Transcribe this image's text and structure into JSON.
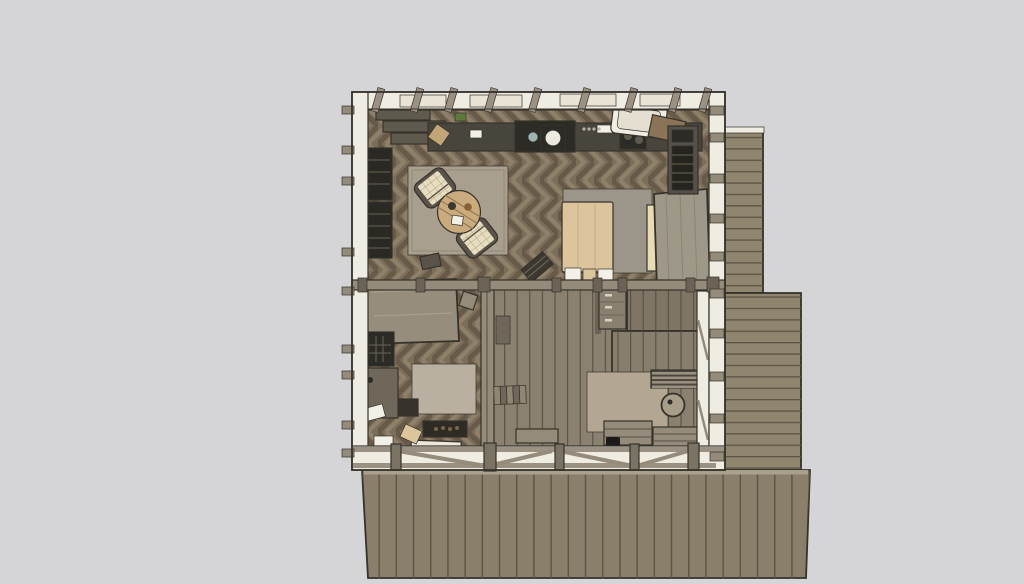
{
  "scene": {
    "kind": "3d-model-top-view",
    "subject": "Top-down rendering of a timber cabin interior with wrap-around wooden deck",
    "style": "sketch-rendered, muted earth tones, no visible text or UI chrome"
  },
  "colors": {
    "background": "#d5d4d6",
    "outline": "#35322b",
    "wall_fill": "#efece1",
    "skylight": "#e8e3d4",
    "beam": "#948b7b",
    "beam_dark": "#6b6355",
    "post": "#7a7263",
    "deck_board": "#90856f",
    "deck_board_dark": "#8a7f6a",
    "deck_line": "#5d5546",
    "deck_edge": "#a89f8c",
    "floor_base": "#7d6e5a",
    "floor_chevron_dark": "#685a48",
    "floor_chevron_light": "#8f806a",
    "hall_plank": "#8a8170",
    "hall_plank_dark": "#7e7565",
    "hall_plank_mid": "#877e6d",
    "hall_plank_line": "#564f43",
    "rug_living": "#a99f8e",
    "rug_living_border": "#948a79",
    "rug_study": "#b9b0a1",
    "rug_porch": "#b3a692",
    "armchair_fabric": "#e7ddc1",
    "armchair_grid": "#b3a17b",
    "armchair_frame": "#5a5349",
    "coffee_table_wood": "#c9ab7e",
    "coffee_table_ring": "#8a6f4e",
    "bowl_dark": "#3b382f",
    "bowl_brown": "#8a5f33",
    "bed_blanket": "#dcc59d",
    "bed_blanket_line": "#c5ad85",
    "bed_carpet": "#9c968a",
    "mattress_roll": "#e9dbb4",
    "pillow": "#f3f0e7",
    "wardrobe": "#9e9889",
    "wardrobe_grain": "#8a8477",
    "counter_base": "#48453c",
    "counter_dark": "#2c2b26",
    "counter_gray": "#5f5a4e",
    "sink": "#eceadf",
    "sink_small": "#9fb3b5",
    "cutting_board": "#c3a678",
    "accent_green": "#5d7a3a",
    "knob": "#b9b2a2",
    "bathtub": "#f0ede3",
    "bathtub_panel": "#e4dfd0",
    "cabinet_wood": "#8a7356",
    "shower_frame": "#55514a",
    "shower_dark": "#26241f",
    "shelf_dark": "#2b2923",
    "shelf_line": "#6b6355",
    "desk_top": "#968d7d",
    "desk_grain": "#a89f8f",
    "stove_dark": "#2e2b25",
    "coal": "#7a6647",
    "hearth_white": "#ece7da",
    "mat_frame": "#cdc6b6",
    "mat_screen": "#3c4258",
    "stair_tread": "#8f8673",
    "stair_riser": "#6f675a",
    "railing_base": "#4a463d",
    "railing_slat": "#9a9180",
    "cabinet_front": "#8a8070",
    "handle": "#d8d2c2",
    "round_table": "#a89d89",
    "kettle": "#1c1a17",
    "stool_dark": "#37332c",
    "hatch_dark": "#2e2b27",
    "rafter": "#9a9183"
  },
  "objects": {
    "building": {
      "label": "Timber cabin seen from directly above"
    },
    "deck_right": {
      "label": "Side deck, horizontal boards"
    },
    "deck_bottom": {
      "label": "Main front deck, vertical boards"
    },
    "living_floor": {
      "label": "Herringbone parquet floor, living room"
    },
    "study_floor": {
      "label": "Herringbone parquet floor, study"
    },
    "hall_floor": {
      "label": "Plank floor, hall and porch room"
    },
    "top_wall": {
      "label": "North wall with exposed rafters"
    },
    "left_wall": {
      "label": "West wall"
    },
    "right_wall": {
      "label": "East wall"
    },
    "bottom_wall": {
      "label": "South wall with cross braces"
    },
    "divider": {
      "label": "Interior divider beam"
    },
    "kitchen": {
      "label": "Kitchen counter run with sink and stove"
    },
    "bathtub": {
      "label": "White bath unit"
    },
    "shower": {
      "label": "Dark shower / utility closet"
    },
    "bookshelf": {
      "label": "Wall bookshelves"
    },
    "living_rug": {
      "label": "Living room area rug"
    },
    "armchair_a": {
      "label": "Checkered armchair (upper)"
    },
    "armchair_b": {
      "label": "Checkered armchair (lower)"
    },
    "coffee_table": {
      "label": "Round wooden coffee table"
    },
    "living_stool": {
      "label": "Small dark stool"
    },
    "bed": {
      "label": "Bed with tan blanket"
    },
    "bed_carpet": {
      "label": "Gray carpet under bed"
    },
    "mattress_roll": {
      "label": "Rolled mattress"
    },
    "pillows": {
      "label": "Pillows at bed foot"
    },
    "bed_bench": {
      "label": "Slatted bench at bed foot"
    },
    "wardrobe": {
      "label": "Gray wardrobe cabinet"
    },
    "desk": {
      "label": "Large work table"
    },
    "desk_chair": {
      "label": "Desk chair"
    },
    "study_shelf": {
      "label": "Dark storage shelving"
    },
    "study_desk_small": {
      "label": "Small side desk"
    },
    "study_rug": {
      "label": "Study area rug"
    },
    "study_stool": {
      "label": "Dark square stool"
    },
    "wood_stove": {
      "label": "Wood stove with embers"
    },
    "hearth": {
      "label": "White hearth slab"
    },
    "doormat": {
      "label": "Entry doormat"
    },
    "hall_post_wall": {
      "label": "Hall post wall"
    },
    "hall_steps": {
      "label": "Short interior steps"
    },
    "hall_shelf": {
      "label": "Narrow wall shelf"
    },
    "hall_bench": {
      "label": "Hall bench"
    },
    "floor_hatch": {
      "label": "Dark floor hatch"
    },
    "drawer_cabinet": {
      "label": "Drawer cabinet"
    },
    "loft_upper": {
      "label": "Upper stair platform"
    },
    "loft_lower": {
      "label": "Lower stair platform"
    },
    "railing": {
      "label": "Stair railing slats"
    },
    "porch_rug": {
      "label": "Porch room rug"
    },
    "round_table": {
      "label": "Small round table"
    },
    "bench_a": {
      "label": "Slatted bench (left)"
    },
    "bench_b": {
      "label": "Slatted bench (right)"
    },
    "kettle": {
      "label": "Dark kettle on floor"
    }
  }
}
